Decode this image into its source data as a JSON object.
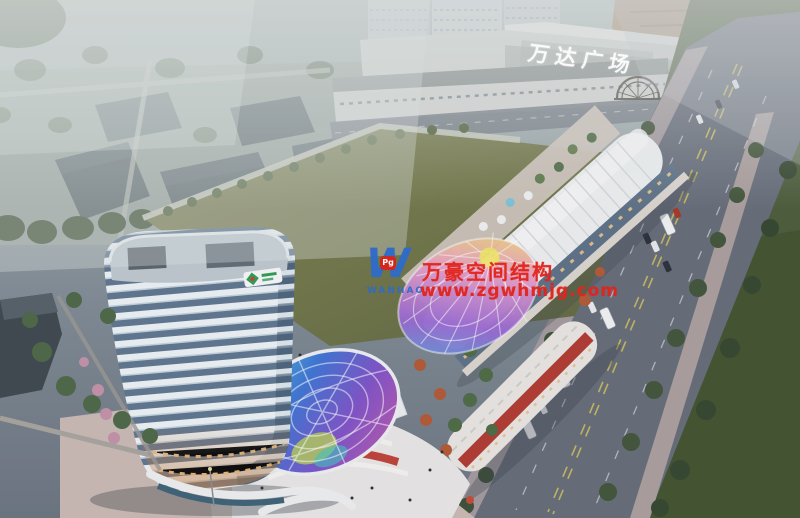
{
  "meta": {
    "description": "Aerial dusk architectural rendering of a mixed-use plaza: white high-rise tower, curved retail podium with rainbow glass canopies, large lawn, and Wanda Plaza mall across the road",
    "width": 800,
    "height": 518
  },
  "signs": {
    "mall_roof_sign": "万达广场"
  },
  "watermark": {
    "logo_letter": "W",
    "logo_badge": "Pg",
    "logo_wordmark": "WANHAO",
    "company": "万豪空间结构",
    "website": "www.zgwhmjg.com"
  },
  "palette": {
    "watermark_red": "#e3241d",
    "brand_red": "#d8231d",
    "brand_blue": "#2e6cc8",
    "haze": "#aeb9b8",
    "lawn_green": "#75794b",
    "road_gray": "#666d79",
    "sidewalk_pink": "#b3a5a2",
    "tower_band_white": "#eef3f6",
    "tower_glass_blue": "#5f7690",
    "roof_white": "#eef0f1",
    "accent_red": "#b23a31",
    "verge_green": "#4c5c3a"
  }
}
